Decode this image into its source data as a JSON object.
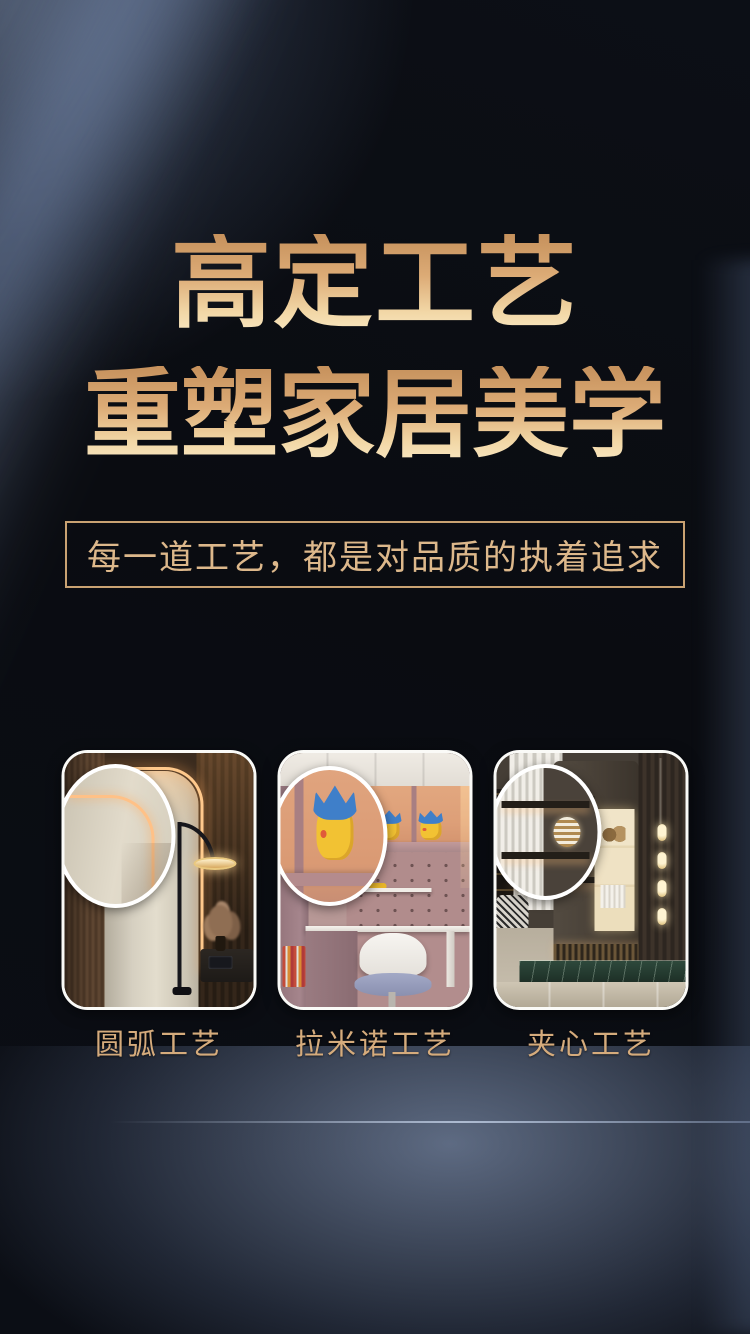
{
  "page": {
    "background_color": "#0a0c11",
    "accent_gold": "#d9b586",
    "glow_blue": "#8fa6c9",
    "card_border": "#fafaf7"
  },
  "hero": {
    "title_line1": "高定工艺",
    "title_line2": "重塑家居美学",
    "subtitle": "每一道工艺，都是对品质的执着追求",
    "title_gradient_top": "#c6915c",
    "title_gradient_bottom": "#f8e7c2"
  },
  "craft_cards": [
    {
      "label": "圆弧工艺",
      "scene": "rounded-arc-wardrobe-with-floor-lamp"
    },
    {
      "label": "拉米诺工艺",
      "scene": "lamello-kids-study-desk-with-pikachu-figures"
    },
    {
      "label": "夹心工艺",
      "scene": "sandwich-core-living-room-shelving"
    }
  ]
}
